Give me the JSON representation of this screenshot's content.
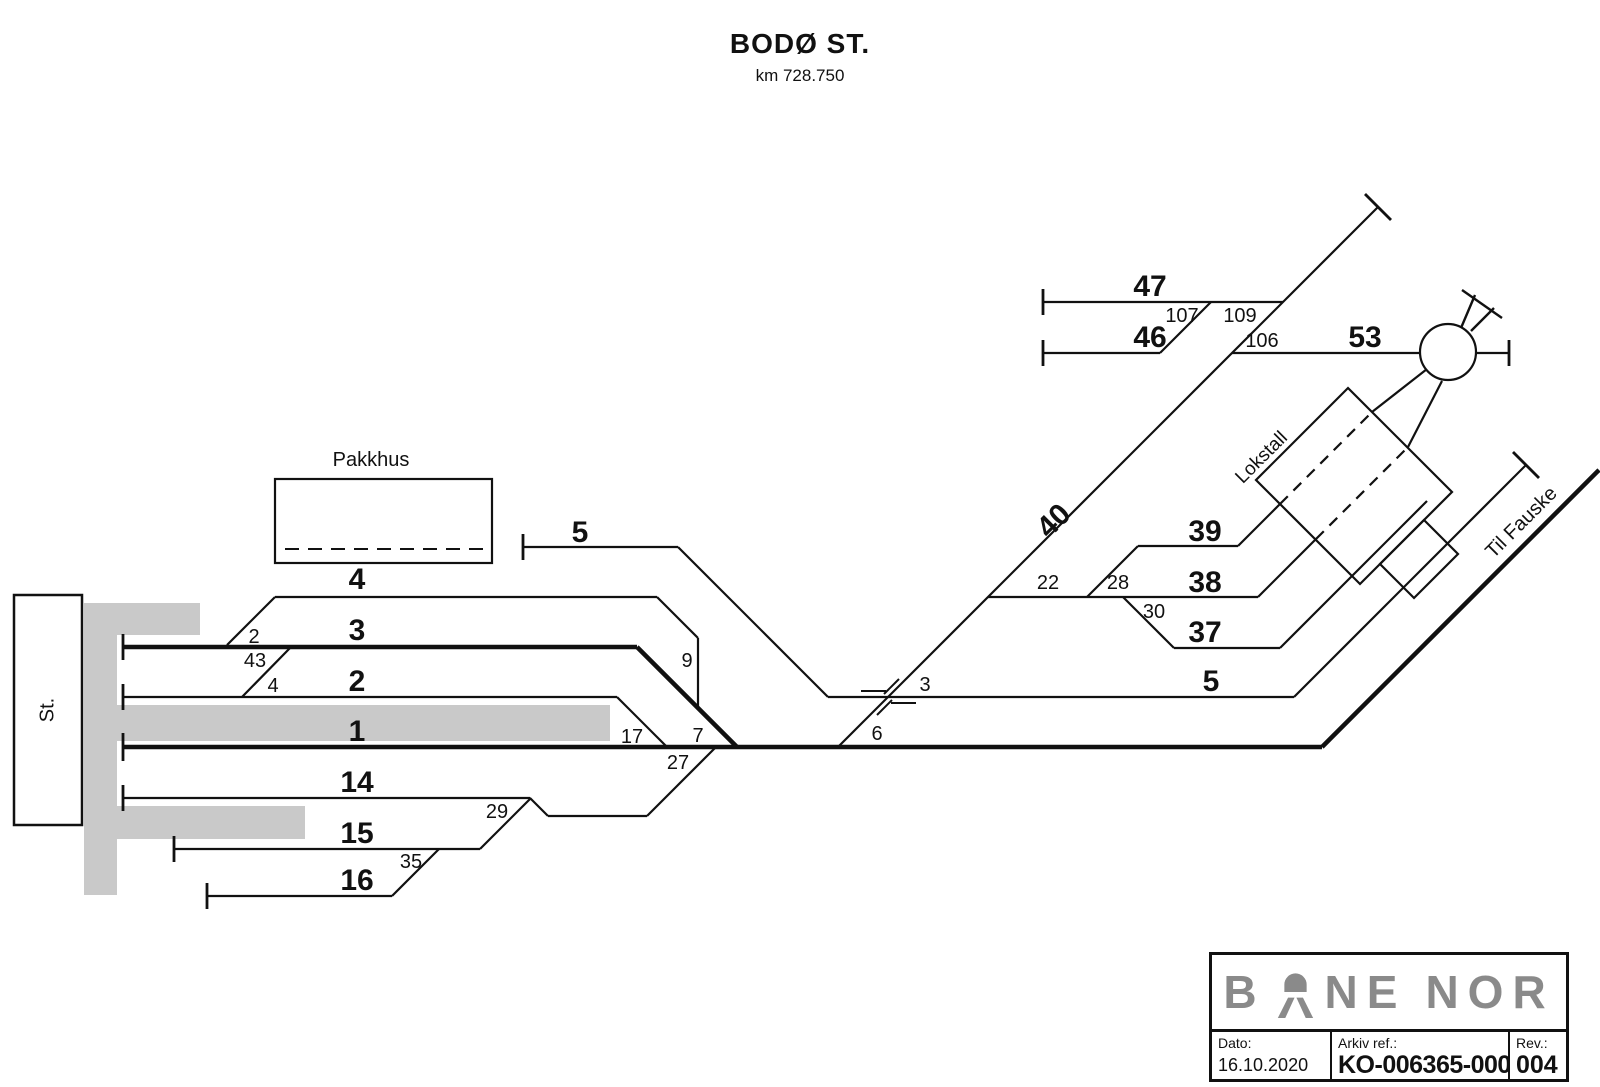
{
  "drawing": {
    "title": "BODØ ST.",
    "km": "km 728.750"
  },
  "labels": {
    "pakkhus": "Pakkhus",
    "station": "St.",
    "lokstall": "Lokstall",
    "til_fauske": "Til Fauske"
  },
  "tracks": {
    "t1": "1",
    "t2": "2",
    "t3": "3",
    "t4": "4",
    "t5_left": "5",
    "t5_right": "5",
    "t14": "14",
    "t15": "15",
    "t16": "16",
    "t37": "37",
    "t38": "38",
    "t39": "39",
    "t40": "40",
    "t46": "46",
    "t47": "47",
    "t53": "53"
  },
  "switches": {
    "s2": "2",
    "s3": "3",
    "s4": "4",
    "s6": "6",
    "s7": "7",
    "s9": "9",
    "s17": "17",
    "s22": "22",
    "s27": "27",
    "s28": "28",
    "s29": "29",
    "s30": "30",
    "s35": "35",
    "s43": "43",
    "s106": "106",
    "s107": "107",
    "s109": "109"
  },
  "title_block": {
    "logo_b": "B",
    "logo_ne": "NE",
    "logo_nor": "NOR",
    "dato_label": "Dato:",
    "dato_value": "16.10.2020",
    "arkiv_label": "Arkiv ref.:",
    "arkiv_value": "KO-006365-000",
    "rev_label": "Rev.:",
    "rev_value": "004"
  },
  "colors": {
    "platform": "#c9c9c9",
    "logo_gray": "#8a8a8a",
    "line": "#111111"
  }
}
